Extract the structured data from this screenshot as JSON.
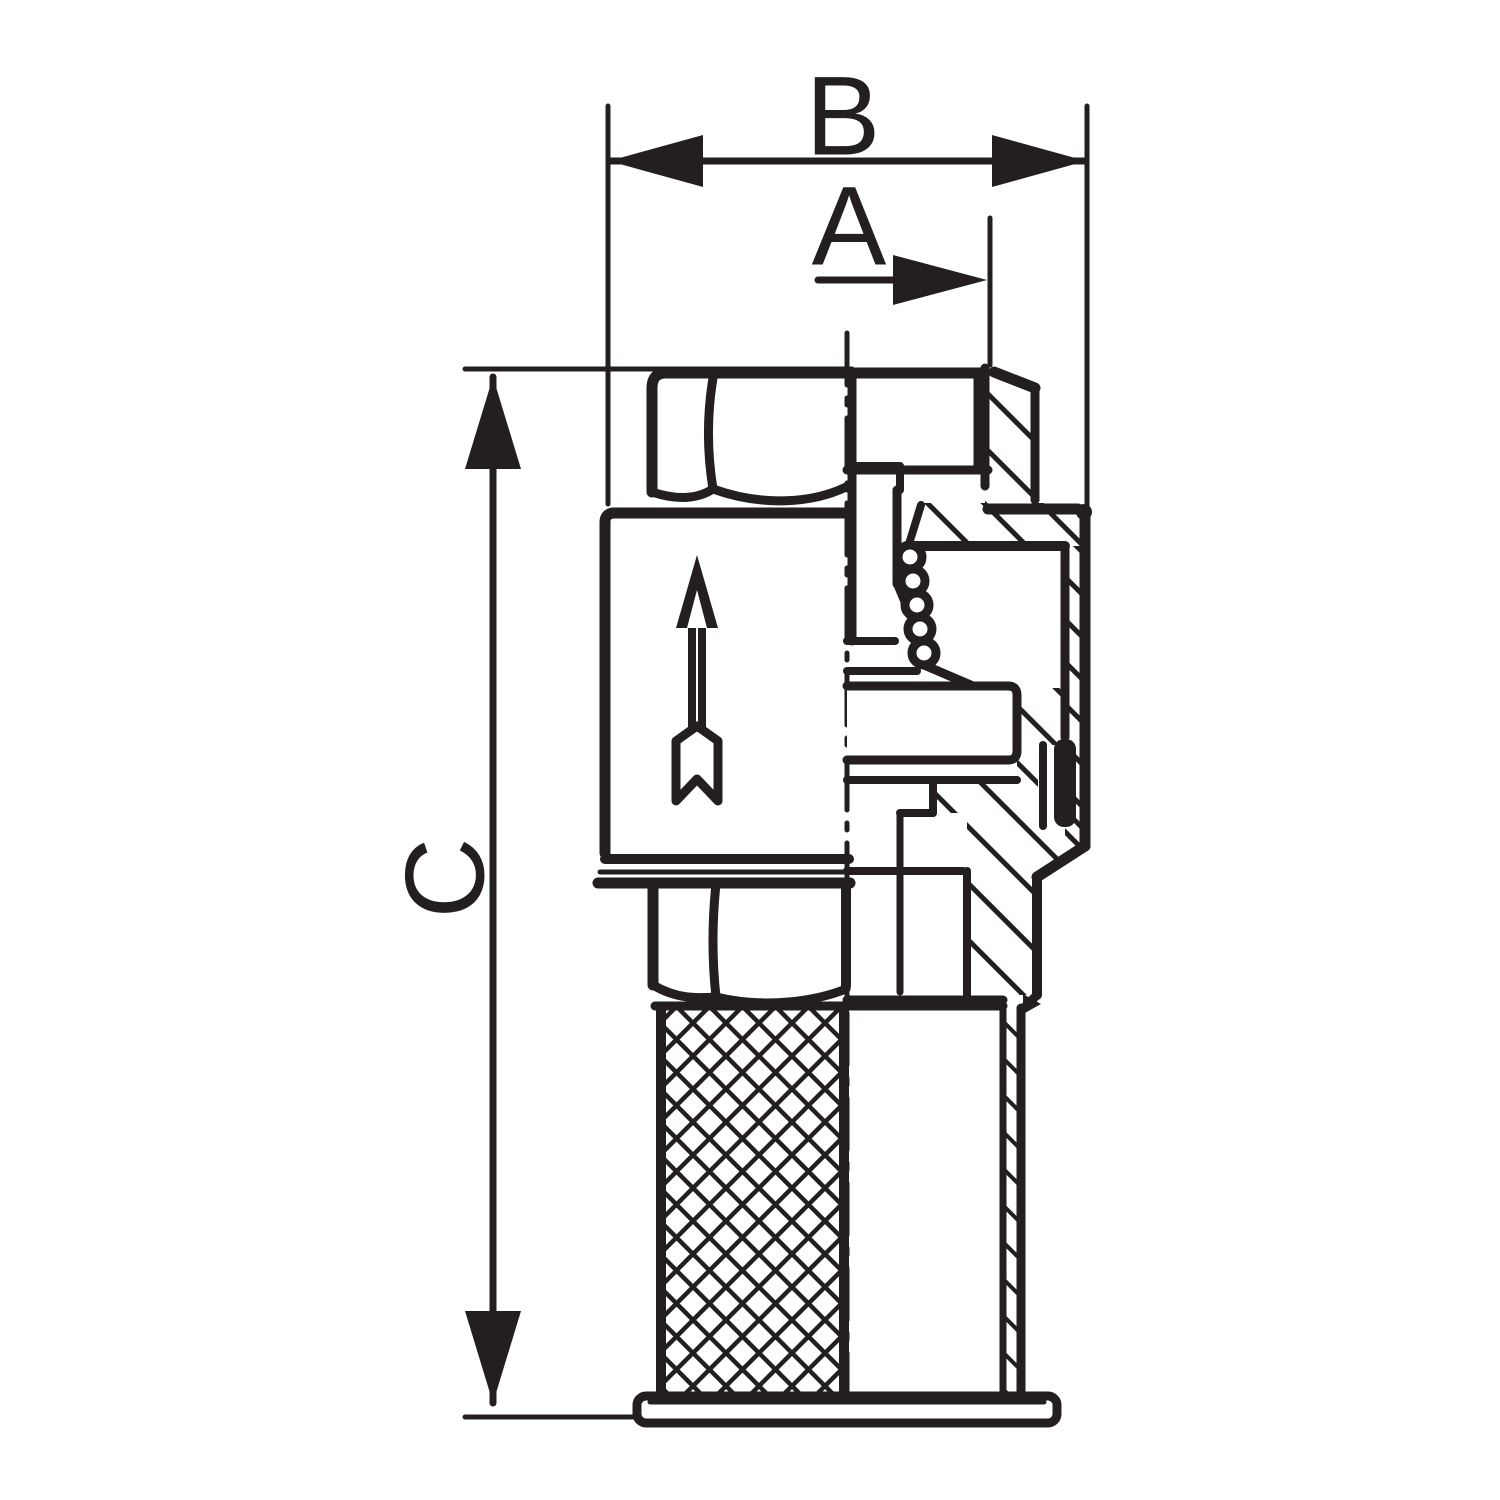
{
  "drawing": {
    "kind": "technical cross-section drawing",
    "colors": {
      "ink": "#231f20",
      "background": "#ffffff"
    }
  },
  "dimension_labels": {
    "overall_width": "B",
    "partial_width": "A",
    "overall_height": "C"
  }
}
